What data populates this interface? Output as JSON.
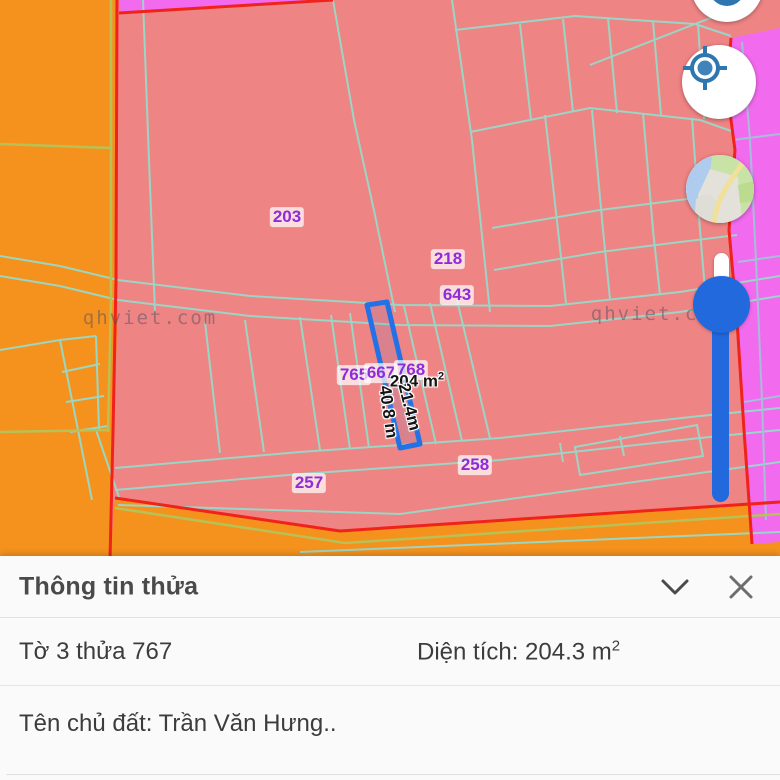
{
  "map": {
    "watermark": "qhviet.com",
    "parcel_labels": [
      {
        "text": "203",
        "x": 287,
        "y": 217
      },
      {
        "text": "218",
        "x": 448,
        "y": 259
      },
      {
        "text": "643",
        "x": 457,
        "y": 295
      },
      {
        "text": "765",
        "x": 354,
        "y": 375
      },
      {
        "text": "667",
        "x": 381,
        "y": 373
      },
      {
        "text": "768",
        "x": 411,
        "y": 370
      },
      {
        "text": "257",
        "x": 309,
        "y": 483
      },
      {
        "text": "258",
        "x": 475,
        "y": 465
      }
    ],
    "measurements": {
      "area_value": "204 m",
      "area_sup": "2",
      "edge_short": "21.4m",
      "edge_long": "40.8 m"
    },
    "colors": {
      "zone_orange": "#F5921E",
      "zone_residential_pink": "#EF8484",
      "zone_magenta": "#F26BEF",
      "parcel_line_teal": "#96DAC9",
      "boundary_red": "#F0221A",
      "selected_parcel_blue": "#2271E6",
      "label_purple": "#8F2BD9"
    }
  },
  "controls": {
    "locate_button": "gps-locate",
    "layers_button": "base-map-switcher",
    "zoom_slider": "zoom-level-slider"
  },
  "panel": {
    "title": "Thông tin thửa",
    "sheet_parcel": "Tờ 3 thửa 767",
    "area_text": "Diện tích: 204.3 m",
    "area_sup": "2",
    "owner": "Tên chủ đất: Trần Văn Hưng.."
  }
}
